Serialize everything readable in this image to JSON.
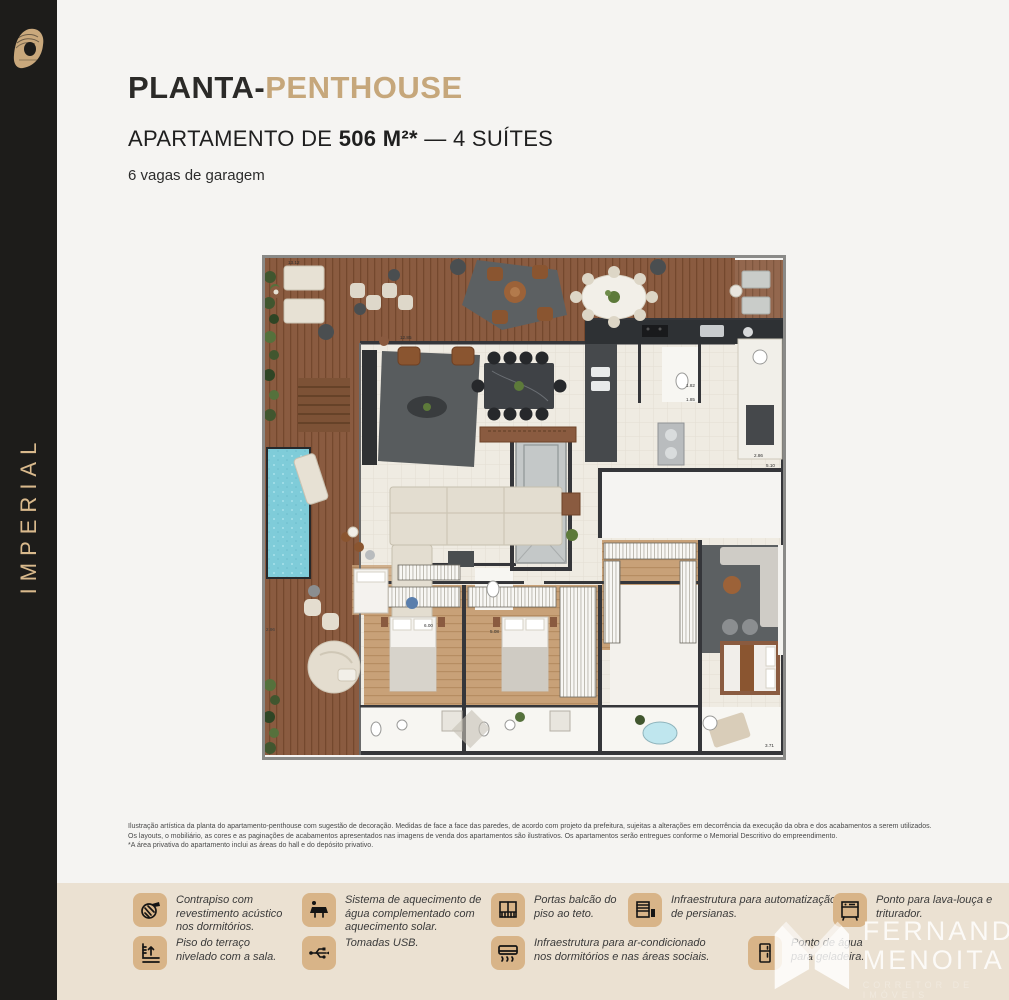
{
  "sidebar": {
    "brand": "IMPERIAL"
  },
  "header": {
    "title_dark": "PLANTA-",
    "title_accent": "PENTHOUSE",
    "subtitle_prefix": "APARTAMENTO DE ",
    "subtitle_bold": "506 M²*",
    "subtitle_suffix": " — 4 SUÍTES",
    "garage": "6 vagas de garagem",
    "accent_color": "#c6a77b"
  },
  "plan": {
    "labels": {
      "l1": "13.12",
      "l2": "12.85",
      "l3": "2.96",
      "l4": "2.86",
      "l5": "5.10",
      "l6": "6.00",
      "l7": "5.08",
      "l8": "3.71",
      "l9": "1.82",
      "l10": "1.85"
    }
  },
  "disclaimer": {
    "line1": "Ilustração artística da planta do apartamento-penthouse com sugestão de decoração. Medidas de face a face das paredes, de acordo com projeto da prefeitura, sujeitas a alterações em decorrência da execução da obra e dos acabamentos a serem utilizados.",
    "line2": "Os layouts, o mobiliário, as cores e as paginações de acabamentos apresentados nas imagens de venda dos apartamentos são ilustrativos. Os apartamentos serão entregues conforme o Memorial Descritivo do empreendimento.",
    "line3": "*A área privativa do apartamento inclui as áreas do hall e do depósito privativo."
  },
  "features": {
    "band_color": "#ebe1d2",
    "tile_color": "#d8b488",
    "items": [
      {
        "icon": "contrapiso-acustico-icon",
        "text": "Contrapiso com revestimento acústico nos dormitórios."
      },
      {
        "icon": "aquecimento-solar-icon",
        "text": "Sistema de aquecimento de água complementado com aquecimento solar."
      },
      {
        "icon": "portas-balcao-icon",
        "text": "Portas balcão do piso ao teto."
      },
      {
        "icon": "persianas-icon",
        "text": "Infraestrutura para automatização de persianas."
      },
      {
        "icon": "lava-louca-icon",
        "text": "Ponto para lava-louça e triturador."
      },
      {
        "icon": "piso-nivelado-icon",
        "text": "Piso do terraço nivelado com a sala."
      },
      {
        "icon": "tomadas-usb-icon",
        "text": "Tomadas USB."
      },
      {
        "icon": "ar-condicionado-icon",
        "text": "Infraestrutura para ar-condicionado nos dormitórios e nas áreas sociais."
      },
      {
        "icon": "geladeira-icon",
        "text": "Ponto de água para geladeira."
      }
    ]
  },
  "watermark": {
    "name_line1": "FERNANDO",
    "name_line2": "MENOITA",
    "tagline": "CORRETOR DE IMÓVEIS"
  }
}
